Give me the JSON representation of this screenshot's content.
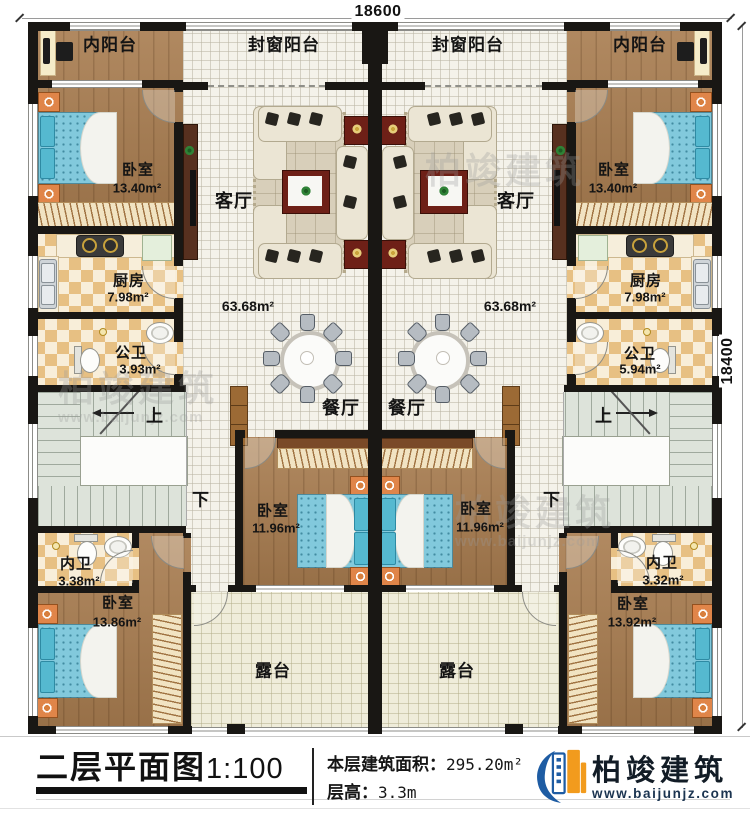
{
  "dimensions": {
    "top": "18600",
    "right": "18400"
  },
  "units": {
    "left": {
      "inner_balcony": "内阳台",
      "enclosed_balcony": "封窗阳台",
      "bedroom_top": {
        "name": "卧室",
        "area": "13.40m²"
      },
      "living_room": "客厅",
      "living_dining_area": "63.68m²",
      "kitchen": {
        "name": "厨房",
        "area": "7.98m²"
      },
      "public_bath": {
        "name": "公卫",
        "area": "3.93m²"
      },
      "dining_room": "餐厅",
      "bedroom_mid": {
        "name": "卧室",
        "area": "11.96m²"
      },
      "stairs_up": "上",
      "stairs_down": "下",
      "ensuite_bath": {
        "name": "内卫",
        "area": "3.38m²"
      },
      "bedroom_bottom": {
        "name": "卧室",
        "area": "13.86m²"
      },
      "terrace": "露台"
    },
    "right": {
      "inner_balcony": "内阳台",
      "enclosed_balcony": "封窗阳台",
      "bedroom_top": {
        "name": "卧室",
        "area": "13.40m²"
      },
      "living_room": "客厅",
      "living_dining_area": "63.68m²",
      "kitchen": {
        "name": "厨房",
        "area": "7.98m²"
      },
      "public_bath": {
        "name": "公卫",
        "area": "5.94m²"
      },
      "dining_room": "餐厅",
      "bedroom_mid": {
        "name": "卧室",
        "area": "11.96m²"
      },
      "stairs_up": "上",
      "stairs_down": "下",
      "ensuite_bath": {
        "name": "内卫",
        "area": "3.32m²"
      },
      "bedroom_bottom": {
        "name": "卧室",
        "area": "13.92m²"
      },
      "terrace": "露台"
    }
  },
  "footer": {
    "plan_title": "二层平面图",
    "plan_scale": "1:100",
    "floor_area_label": "本层建筑面积：",
    "floor_area_value": "295.20m²",
    "floor_height_label": "层高：",
    "floor_height_value": "3.3m",
    "brand_name": "柏竣建筑",
    "brand_url": "www.baijunjz.com"
  },
  "watermark": {
    "brand": "柏竣建筑",
    "url": "www.baijunjz.com"
  }
}
